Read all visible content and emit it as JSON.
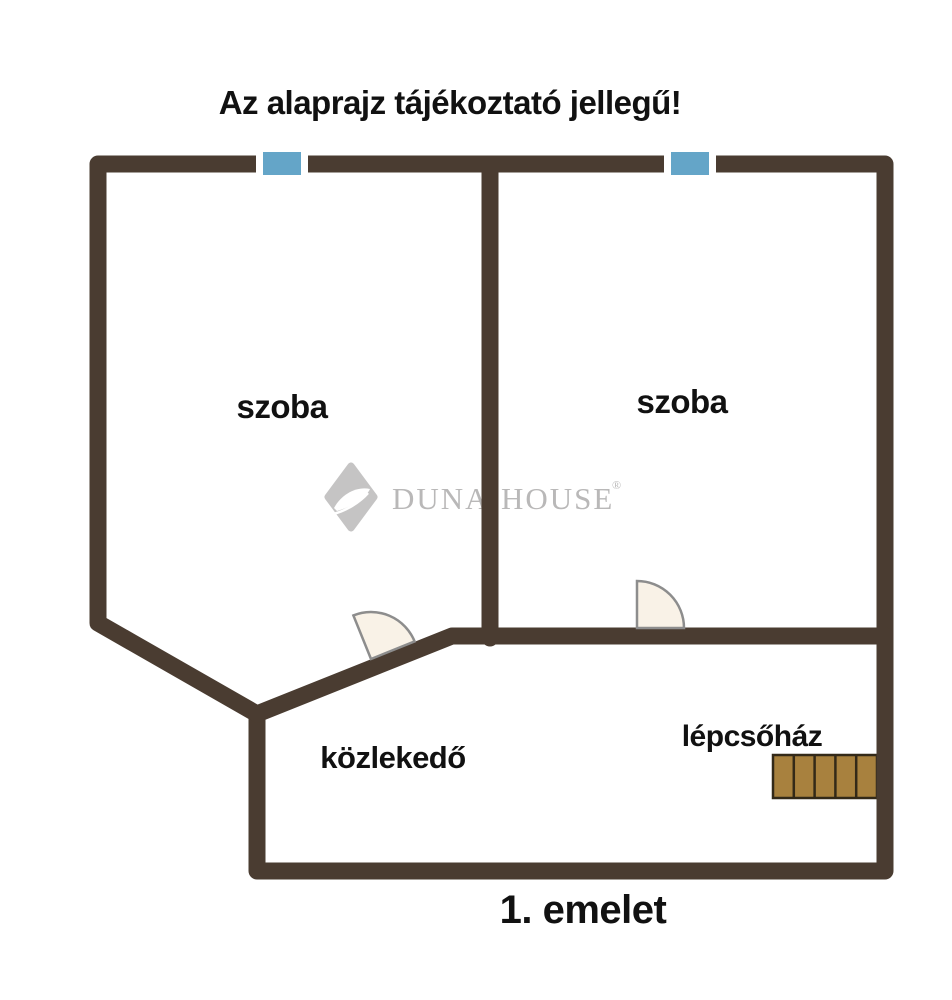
{
  "title": "Az alaprajz tájékoztató jellegű!",
  "floor_label": "1. emelet",
  "rooms": {
    "room_left": "szoba",
    "room_right": "szoba",
    "hallway": "közlekedő",
    "stairwell": "lépcsőház"
  },
  "watermark": {
    "brand": "Duna House",
    "word1": "DUNA",
    "word2": "HOUSE",
    "registered": "®"
  },
  "icons": {
    "window": "window-marker",
    "door": "door-swing",
    "stairs": "stairs",
    "logo_mark": "duna-house-diamond"
  },
  "colors": {
    "wall": "#4a3c31",
    "window_glass": "#64a5c8",
    "window_frame": "#ffffff",
    "door_fill": "#f9f2e7",
    "door_stroke": "#8d8d8d",
    "stairs_fill": "#a8813e",
    "stairs_stroke": "#332918",
    "watermark": "#c5c4c4",
    "watermark_text": "#b9b8b8",
    "text": "#111111"
  }
}
